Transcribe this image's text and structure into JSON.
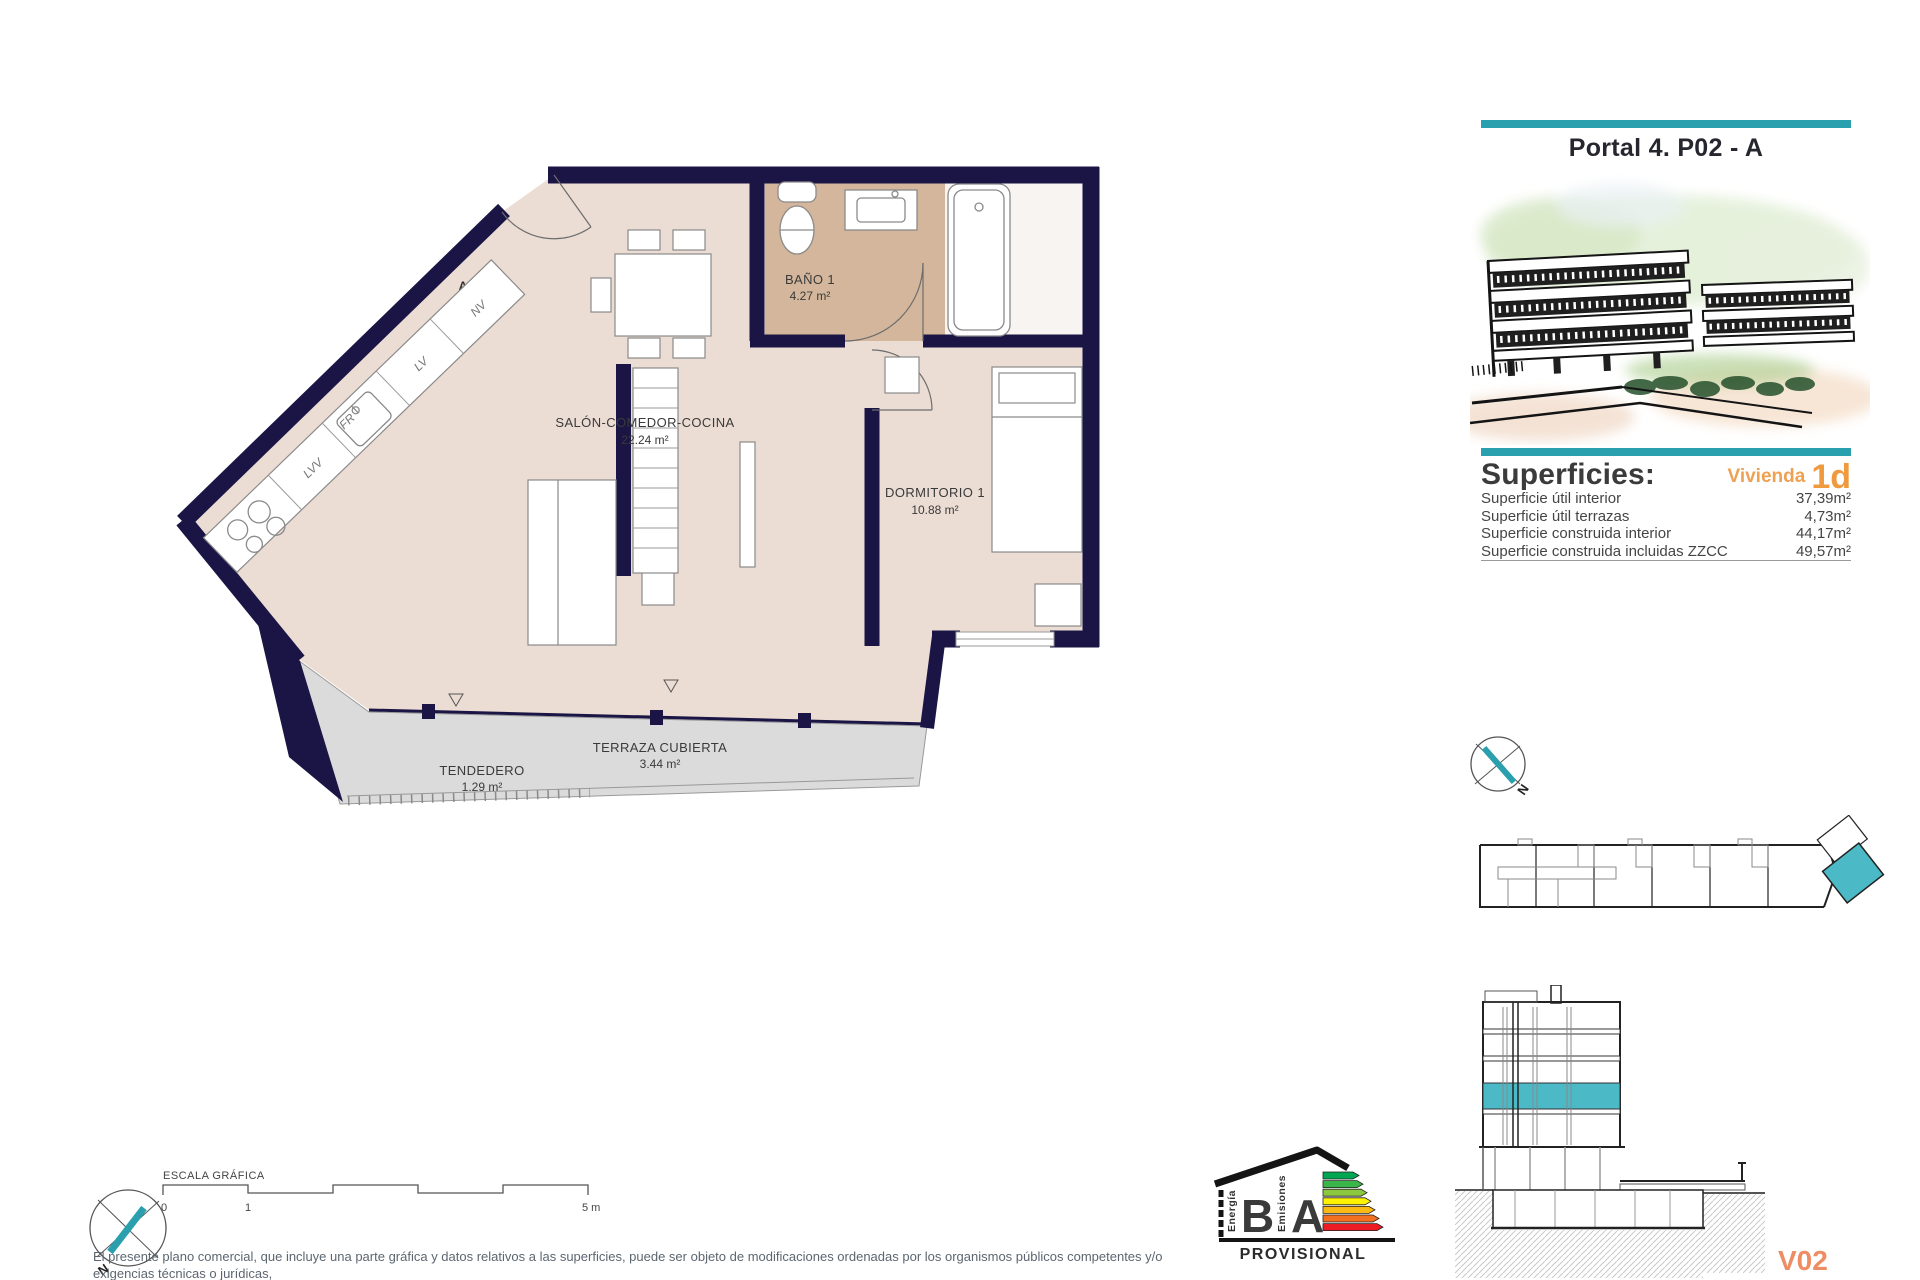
{
  "plan": {
    "rooms": [
      {
        "name": "SALÓN-COMEDOR-COCINA",
        "area": "22.24 m²"
      },
      {
        "name": "BAÑO 1",
        "area": "4.27 m²"
      },
      {
        "name": "DORMITORIO 1",
        "area": "10.88 m²"
      },
      {
        "name": "TERRAZA CUBIERTA",
        "area": "3.44 m²"
      },
      {
        "name": "TENDEDERO",
        "area": "1.29 m²"
      }
    ],
    "kitchen": {
      "lvv": "LVV",
      "fr": "FR",
      "lv": "LV",
      "nv": "NV"
    },
    "entrance_label": "A"
  },
  "sidebar": {
    "title": "Portal 4. P02 - A",
    "superficies": {
      "heading": "Superficies:",
      "vivienda_label": "Vivienda",
      "vivienda_code": "1d",
      "rows": [
        {
          "label": "Superficie útil interior",
          "value": "37,39m²"
        },
        {
          "label": "Superficie útil terrazas",
          "value": "4,73m²"
        },
        {
          "label": "Superficie construida interior",
          "value": "44,17m²"
        },
        {
          "label": "Superficie construida incluidas ZZCC",
          "value": "49,57m²"
        }
      ]
    },
    "version": "V02"
  },
  "footer": {
    "scale_bar": {
      "label": "ESCALA GRÁFICA",
      "tick_0": "0",
      "tick_1": "1",
      "tick_5": "5 m"
    },
    "disclaimer_line1": "El presente plano comercial, que incluye una parte gráfica y datos relativos a las superficies, puede ser objeto de modificaciones ordenadas por los organismos públicos competentes y/o exigencias técnicas o jurídicas,",
    "disclaimer_line2": "siempre y cuando estén justificados y no supongan alteraciones sustanciales. El mobiliario mostrado no está incluido y el equipamiento del inmueble será el indicado en la correspondiente memoria de calidades",
    "energy_label": {
      "energia": "Energía",
      "energia_rating": "B",
      "emisiones": "Emisiones",
      "emisiones_rating": "A",
      "status": "PROVISIONAL"
    }
  },
  "compass": {
    "north": "N"
  },
  "colors": {
    "accent_teal": "#2a9fae",
    "highlight_teal": "#4bb9c6",
    "orange_vivienda": "#efa153",
    "orange_code": "#ef9a3e",
    "salmon_version": "#ee8c64",
    "wall_navy": "#1a1545",
    "floor_beige": "#ecddd4",
    "bathroom_tan": "#d3b69b",
    "terrace_grey": "#dbdbdb",
    "energy_scale": [
      "#00a651",
      "#39b54a",
      "#8dc63f",
      "#fff200",
      "#fdb913",
      "#f37021",
      "#ed1c24"
    ]
  }
}
